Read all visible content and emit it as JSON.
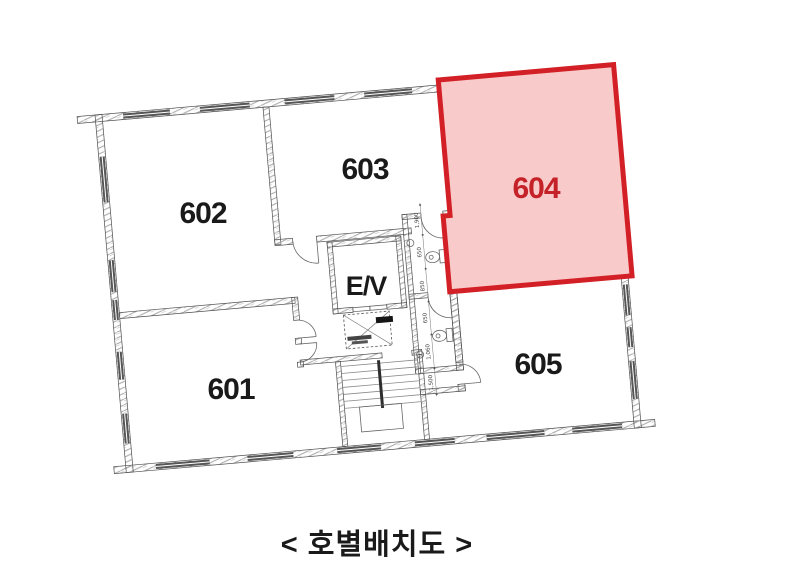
{
  "figure": {
    "type": "floor-plan",
    "caption": "< 호별배치도 >",
    "highlighted_unit": "604"
  },
  "rooms": [
    {
      "id": "601",
      "label": "601",
      "highlighted": false
    },
    {
      "id": "602",
      "label": "602",
      "highlighted": false
    },
    {
      "id": "603",
      "label": "603",
      "highlighted": false
    },
    {
      "id": "604",
      "label": "604",
      "highlighted": true
    },
    {
      "id": "605",
      "label": "605",
      "highlighted": false
    },
    {
      "id": "elevator",
      "label": "E/V",
      "highlighted": false
    }
  ],
  "dimensions": [
    "1,900",
    "650",
    "850",
    "650",
    "1,060",
    "1,500"
  ],
  "colors": {
    "highlight_fill": "#f8caca",
    "highlight_border": "#d32026",
    "highlight_text": "#c42128",
    "ink": "#1a1a1a",
    "wall_line": "#4f4f4f",
    "hatch": "#a8a8a8",
    "window_bar": "#565656",
    "detail_line": "#666666"
  }
}
